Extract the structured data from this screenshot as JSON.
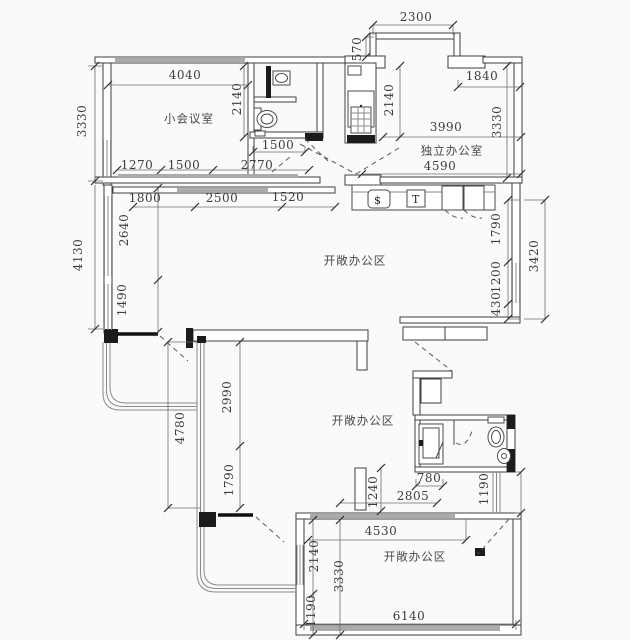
{
  "drawing": {
    "type": "architectural floor plan",
    "units": "mm"
  },
  "icons": {
    "drain_glyph": "$",
    "tap_glyph": "T"
  },
  "rooms": [
    {
      "name": "小会议室"
    },
    {
      "name": "独立办公室"
    },
    {
      "name": "开敞办公区"
    },
    {
      "name": "开敞办公区"
    },
    {
      "name": "开敞办公区"
    }
  ],
  "labels": [
    {
      "t": "2300",
      "kind": "dim",
      "x": 416,
      "y": 17,
      "v": 0
    },
    {
      "t": "570",
      "kind": "dim",
      "x": 357,
      "y": 49,
      "v": 1
    },
    {
      "t": "4040",
      "kind": "dim",
      "x": 185,
      "y": 75,
      "v": 0
    },
    {
      "t": "1840",
      "kind": "dim",
      "x": 482,
      "y": 76,
      "v": 0
    },
    {
      "t": "2140",
      "kind": "dim",
      "x": 237,
      "y": 99,
      "v": 1
    },
    {
      "t": "2140",
      "kind": "dim",
      "x": 389,
      "y": 100,
      "v": 1
    },
    {
      "t": "3330",
      "kind": "dim",
      "x": 82,
      "y": 121,
      "v": 1
    },
    {
      "t": "3330",
      "kind": "dim",
      "x": 497,
      "y": 122,
      "v": 1
    },
    {
      "t": "3990",
      "kind": "dim",
      "x": 446,
      "y": 127,
      "v": 0
    },
    {
      "t": "小会议室",
      "kind": "room",
      "x": 189,
      "y": 119,
      "v": 0
    },
    {
      "t": "独立办公室",
      "kind": "room",
      "x": 452,
      "y": 151,
      "v": 0
    },
    {
      "t": "1500",
      "kind": "dim",
      "x": 278,
      "y": 145,
      "v": 0
    },
    {
      "t": "4590",
      "kind": "dim",
      "x": 440,
      "y": 166,
      "v": 0
    },
    {
      "t": "1270",
      "kind": "dim",
      "x": 137,
      "y": 165,
      "v": 0
    },
    {
      "t": "1500",
      "kind": "dim",
      "x": 184,
      "y": 165,
      "v": 0
    },
    {
      "t": "2770",
      "kind": "dim",
      "x": 257,
      "y": 165,
      "v": 0
    },
    {
      "t": "1800",
      "kind": "dim",
      "x": 145,
      "y": 198,
      "v": 0
    },
    {
      "t": "2500",
      "kind": "dim",
      "x": 222,
      "y": 198,
      "v": 0
    },
    {
      "t": "1520",
      "kind": "dim",
      "x": 288,
      "y": 197,
      "v": 0
    },
    {
      "t": "4130",
      "kind": "dim",
      "x": 78,
      "y": 255,
      "v": 1
    },
    {
      "t": "2640",
      "kind": "dim",
      "x": 124,
      "y": 230,
      "v": 1
    },
    {
      "t": "1490",
      "kind": "dim",
      "x": 122,
      "y": 300,
      "v": 1
    },
    {
      "t": "开敞办公区",
      "kind": "room",
      "x": 355,
      "y": 261,
      "v": 0
    },
    {
      "t": "1790",
      "kind": "dim",
      "x": 496,
      "y": 229,
      "v": 1
    },
    {
      "t": "1200",
      "kind": "dim",
      "x": 496,
      "y": 277,
      "v": 1
    },
    {
      "t": "430",
      "kind": "dim",
      "x": 496,
      "y": 304,
      "v": 1
    },
    {
      "t": "3420",
      "kind": "dim",
      "x": 534,
      "y": 256,
      "v": 1
    },
    {
      "t": "2990",
      "kind": "dim",
      "x": 227,
      "y": 397,
      "v": 1
    },
    {
      "t": "4780",
      "kind": "dim",
      "x": 180,
      "y": 428,
      "v": 1
    },
    {
      "t": "1790",
      "kind": "dim",
      "x": 229,
      "y": 480,
      "v": 1
    },
    {
      "t": "开敞办公区",
      "kind": "room",
      "x": 363,
      "y": 421,
      "v": 0
    },
    {
      "t": "780",
      "kind": "dim",
      "x": 429,
      "y": 478,
      "v": 0
    },
    {
      "t": "1240",
      "kind": "dim",
      "x": 373,
      "y": 492,
      "v": 1
    },
    {
      "t": "2805",
      "kind": "dim",
      "x": 413,
      "y": 496,
      "v": 0
    },
    {
      "t": "1190",
      "kind": "dim",
      "x": 484,
      "y": 489,
      "v": 1
    },
    {
      "t": "4530",
      "kind": "dim",
      "x": 381,
      "y": 531,
      "v": 0
    },
    {
      "t": "开敞办公区",
      "kind": "room",
      "x": 415,
      "y": 557,
      "v": 0
    },
    {
      "t": "2140",
      "kind": "dim",
      "x": 314,
      "y": 556,
      "v": 1
    },
    {
      "t": "3330",
      "kind": "dim",
      "x": 339,
      "y": 576,
      "v": 1
    },
    {
      "t": "1190",
      "kind": "dim",
      "x": 311,
      "y": 611,
      "v": 1
    },
    {
      "t": "6140",
      "kind": "dim",
      "x": 409,
      "y": 616,
      "v": 0
    }
  ]
}
